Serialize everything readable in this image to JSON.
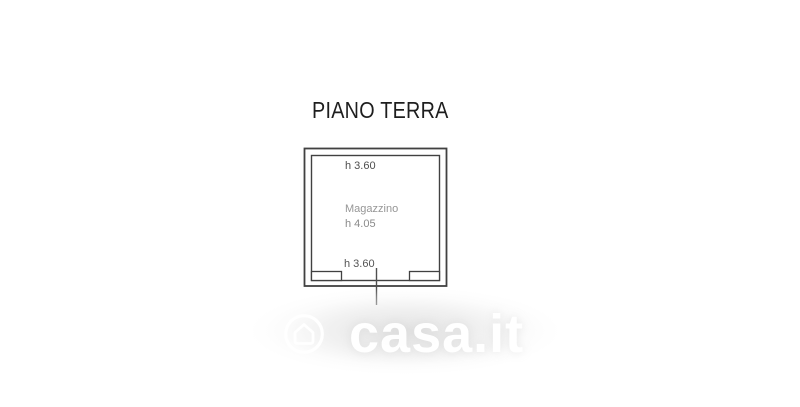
{
  "title": {
    "text": "PIANO TERRA"
  },
  "floorplan": {
    "top_height_label": "h 3.60",
    "bottom_height_label": "h 3.60",
    "room": {
      "name": "Magazzino",
      "height_label": "h 4.05"
    }
  },
  "watermark": {
    "brand_text": "casa.it",
    "icon": "casa-house-circle-icon"
  },
  "colors": {
    "background": "#ffffff",
    "plan_line": "#414141",
    "title_text": "#1e1e1e",
    "dim_label_dark": "#4e4e4e",
    "room_label_gray": "#969696",
    "watermark_white": "#ffffff",
    "watermark_halo": "#e4e4e4"
  }
}
